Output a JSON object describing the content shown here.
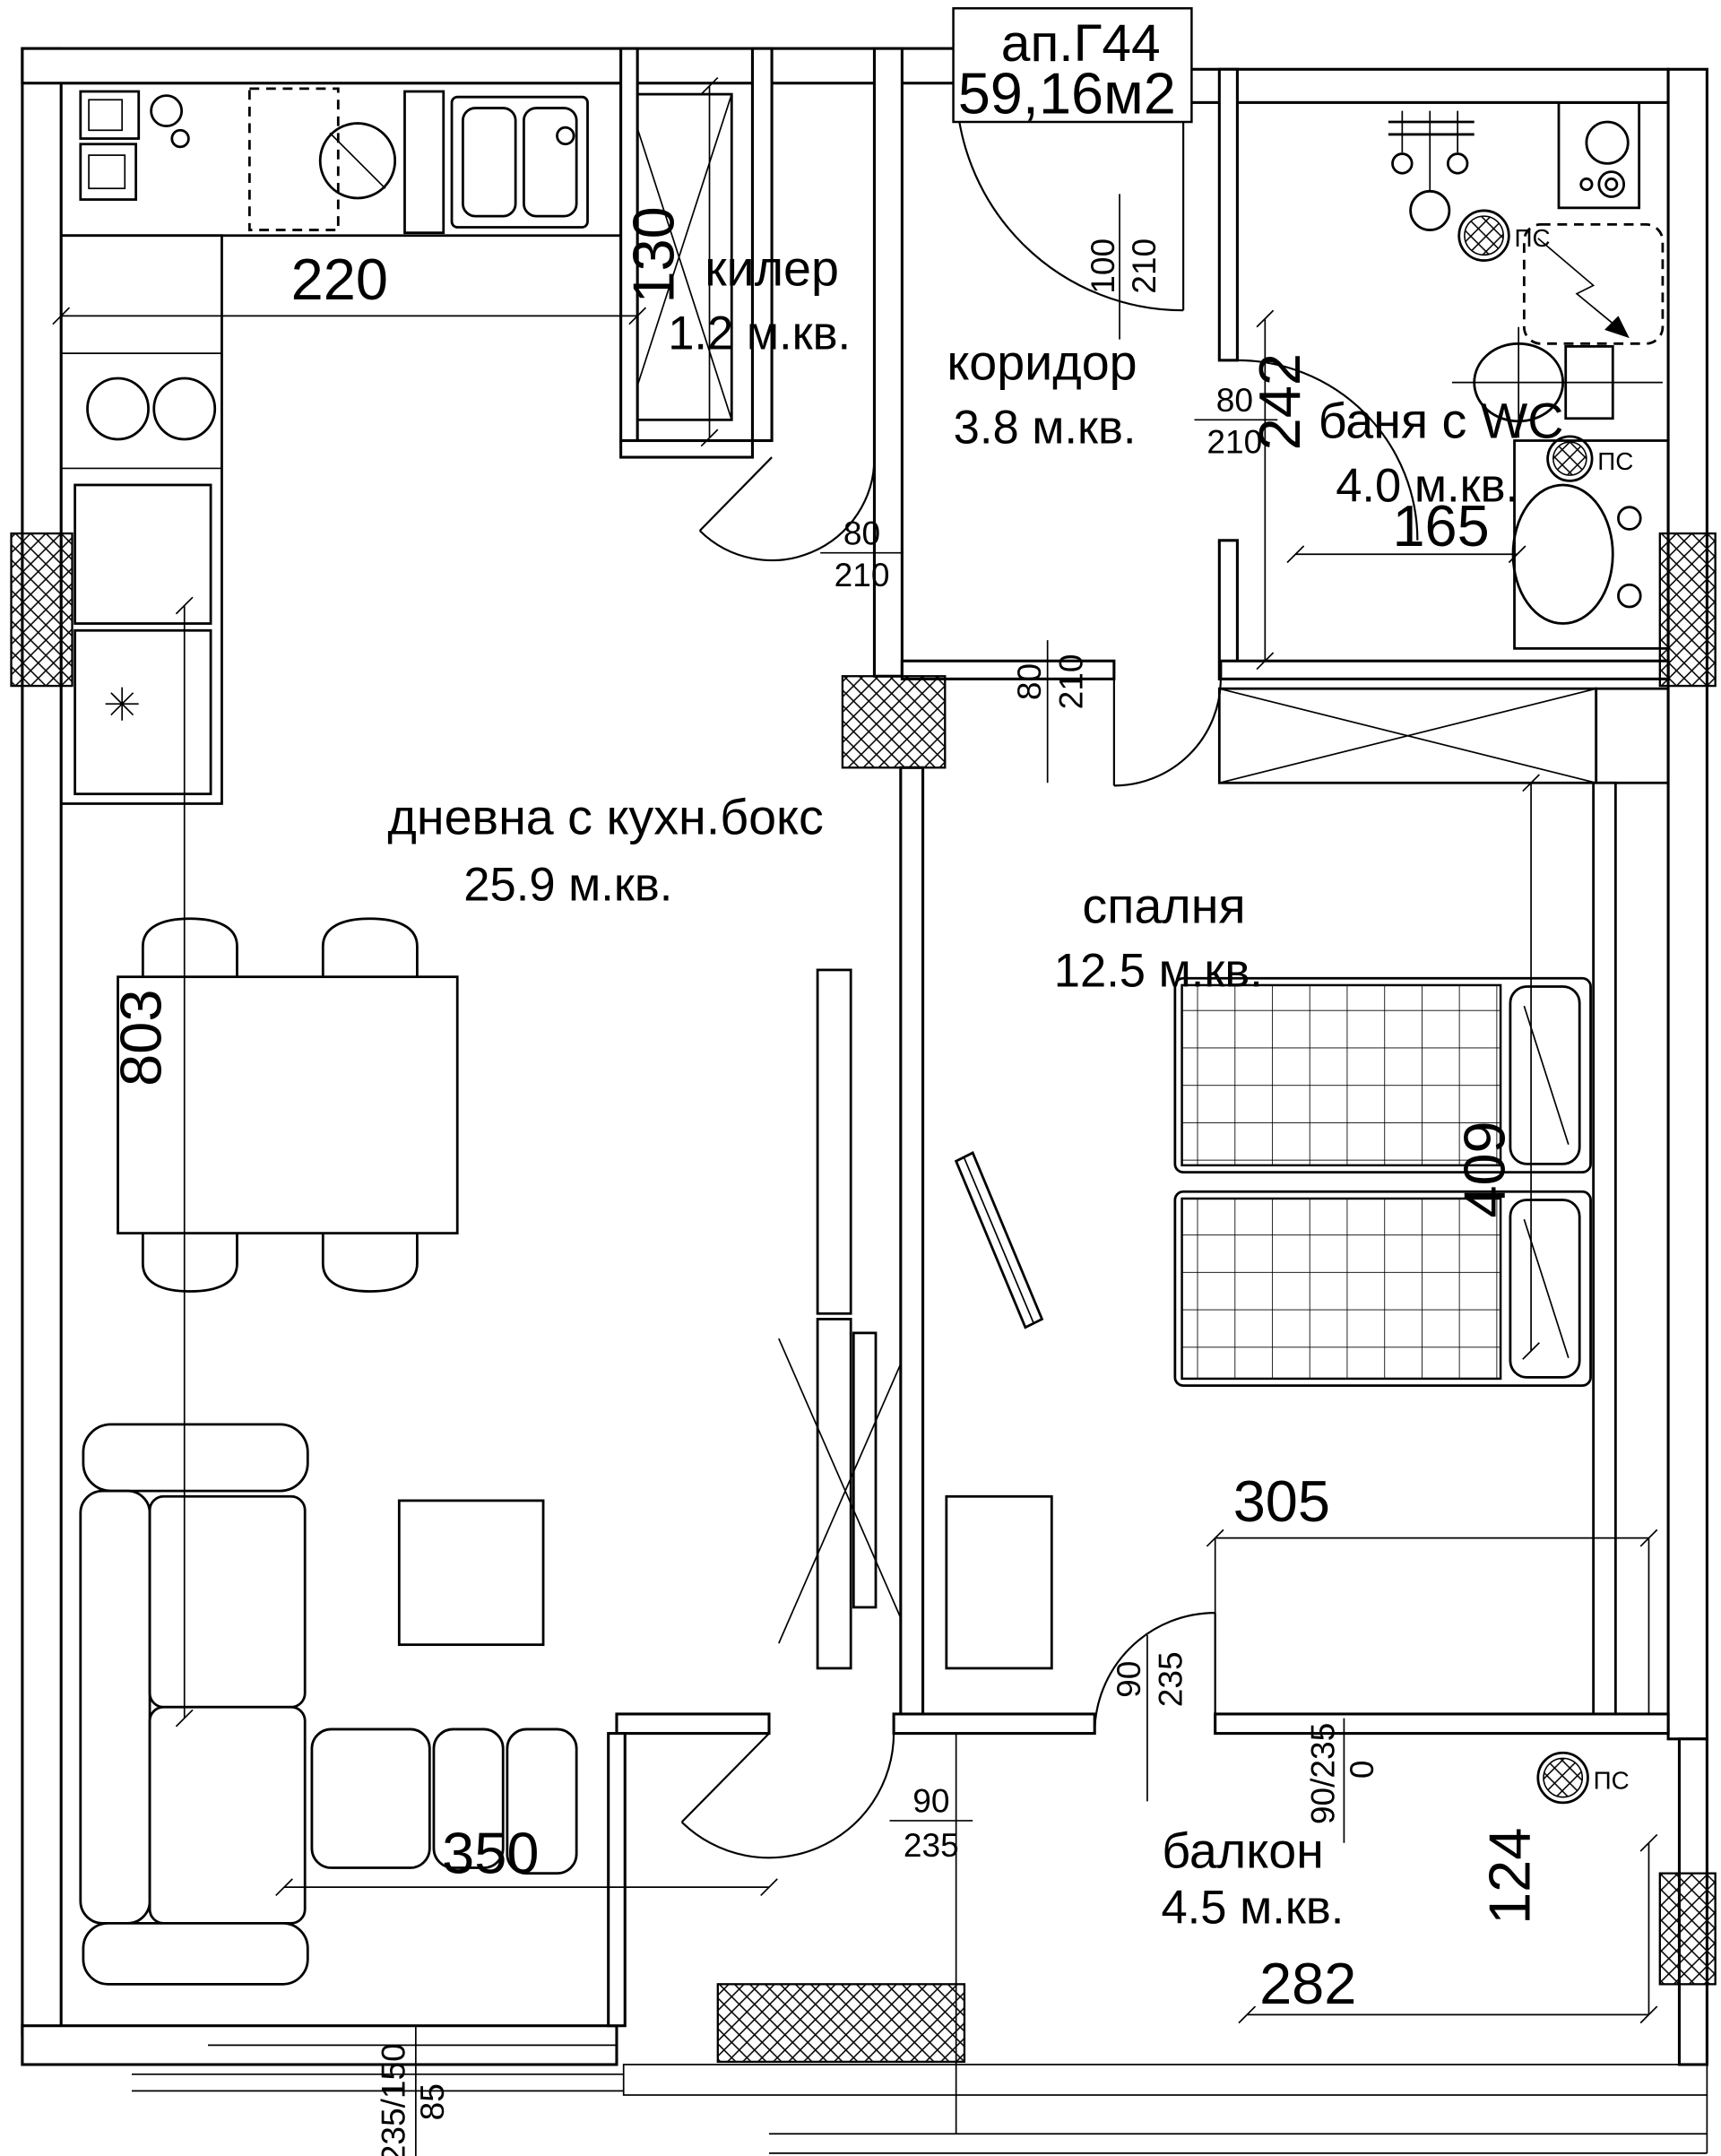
{
  "title_block": {
    "apartment": "ап.Г44",
    "area": "59,16м2"
  },
  "rooms": {
    "storage": {
      "name": "килер",
      "area": "1.2 м.кв."
    },
    "corridor": {
      "name": "коридор",
      "area": "3.8 м.кв."
    },
    "bathroom": {
      "name": "баня с WC",
      "area": "4.0 м.кв."
    },
    "living": {
      "name": "дневна с кухн.бокс",
      "area": "25.9 м.кв."
    },
    "bedroom": {
      "name": "спалня",
      "area": "12.5 м.кв."
    },
    "balcony": {
      "name": "балкон",
      "area": "4.5 м.кв."
    }
  },
  "dims": {
    "kitchen_run": "220",
    "storage_width": "130",
    "corridor_length": "242",
    "bathroom_width": "165",
    "living_length": "803",
    "bedroom_length": "409",
    "bedroom_width": "305",
    "living_width": "350",
    "balcony_width": "282",
    "balcony_depth": "124"
  },
  "openings": {
    "entrance": {
      "width": "100",
      "height": "210"
    },
    "bathroom_door": {
      "width": "80",
      "height": "210"
    },
    "living_door": {
      "width": "80",
      "height": "210"
    },
    "bedroom_door": {
      "width": "80",
      "height": "210"
    },
    "bedroom_balcony_door": {
      "width": "90",
      "height": "235"
    },
    "living_balcony_door": {
      "width": "90",
      "height": "235"
    },
    "balcony_door_note": {
      "label": "90/235",
      "offset": "0"
    },
    "living_window": {
      "spec": "235/150",
      "sill": "85"
    }
  },
  "symbols": {
    "shaft_label": "ПС"
  },
  "colors": {
    "line": "#000000",
    "background": "#ffffff"
  }
}
